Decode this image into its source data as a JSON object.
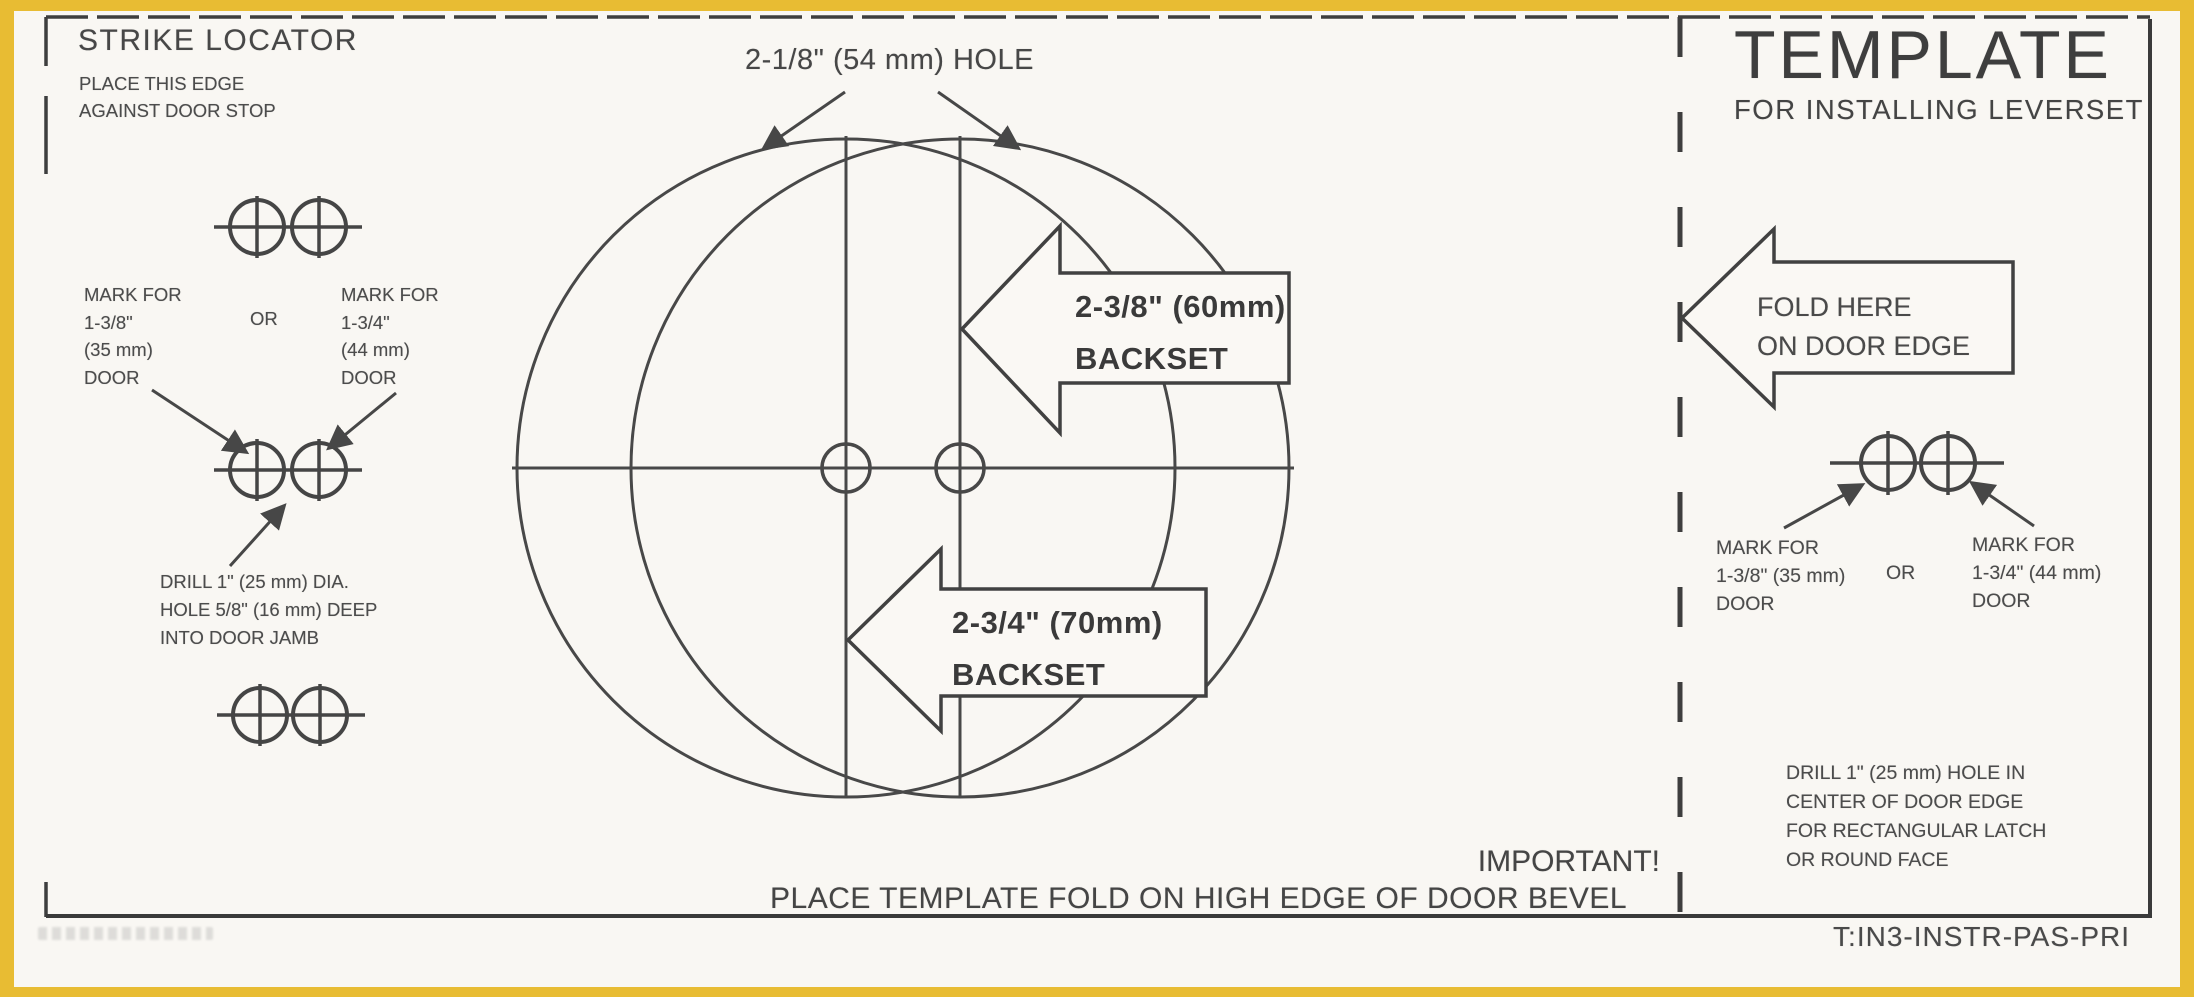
{
  "colors": {
    "frame": "#e8bc33",
    "paper": "#f9f7f3",
    "ink": "#454545"
  },
  "strike_locator": {
    "title": "STRIKE LOCATOR",
    "edge_note": {
      "l1": "PLACE THIS EDGE",
      "l2": "AGAINST DOOR STOP"
    },
    "mark_left": {
      "l1": "MARK FOR",
      "l2": "1-3/8\"",
      "l3": "(35 mm)",
      "l4": "DOOR"
    },
    "or": "OR",
    "mark_right": {
      "l1": "MARK FOR",
      "l2": "1-3/4\"",
      "l3": "(44 mm)",
      "l4": "DOOR"
    },
    "drill_note": {
      "l1": "DRILL 1\" (25 mm) DIA.",
      "l2": "HOLE 5/8\" (16 mm) DEEP",
      "l3": "INTO DOOR JAMB"
    }
  },
  "hole_diagram": {
    "hole_label": "2-1/8\" (54 mm) HOLE",
    "backset_small": {
      "l1": "2-3/8\" (60mm)",
      "l2": "BACKSET"
    },
    "backset_large": {
      "l1": "2-3/4\" (70mm)",
      "l2": "BACKSET"
    },
    "important": "IMPORTANT!",
    "important_note": "PLACE TEMPLATE FOLD ON HIGH EDGE OF DOOR BEVEL"
  },
  "template_panel": {
    "title": "TEMPLATE",
    "subtitle": "FOR INSTALLING LEVERSET",
    "fold_arrow": {
      "l1": "FOLD HERE",
      "l2": "ON DOOR EDGE"
    },
    "mark_left": {
      "l1": "MARK FOR",
      "l2": "1-3/8\" (35 mm)",
      "l3": "DOOR"
    },
    "or": "OR",
    "mark_right": {
      "l1": "MARK FOR",
      "l2": "1-3/4\" (44 mm)",
      "l3": "DOOR"
    },
    "drill_note": {
      "l1": "DRILL 1\" (25 mm) HOLE IN",
      "l2": "CENTER OF DOOR EDGE",
      "l3": "FOR RECTANGULAR LATCH",
      "l4": "OR ROUND FACE"
    },
    "part_code": "T:IN3-INSTR-PAS-PRI"
  }
}
